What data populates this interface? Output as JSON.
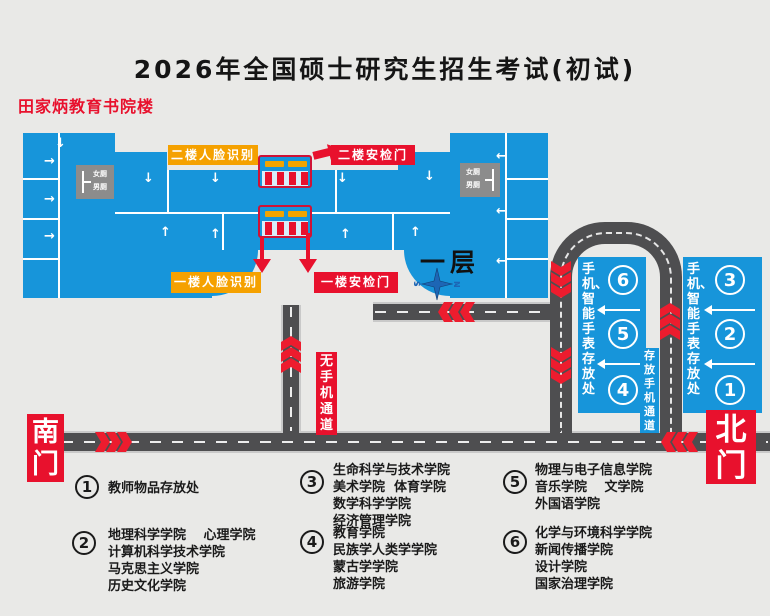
{
  "title": "2026年全国硕士研究生招生考试(初试)",
  "building": {
    "name": "田家炳教育书院楼",
    "floor_label": "一层",
    "restroom_female": "女厕",
    "restroom_male": "男厕",
    "labels": {
      "face_l2": "二楼人脸识别",
      "security_l2": "二楼安检门",
      "face_l1": "一楼人脸识别",
      "security_l1": "一楼安检门"
    }
  },
  "gates": {
    "south": "南门",
    "north": "北门"
  },
  "paths": {
    "no_phone": "无手机通道",
    "store_phone": "存放手机通道"
  },
  "storage_boxes": [
    {
      "label": "手机、智能手表存放处",
      "numbers": [
        "6",
        "5",
        "4"
      ]
    },
    {
      "label": "手机、智能手表存放处",
      "numbers": [
        "3",
        "2",
        "1"
      ]
    }
  ],
  "compass": {
    "left": "S",
    "right": "N"
  },
  "legend": [
    {
      "num": "1",
      "lines": [
        "教师物品存放处"
      ]
    },
    {
      "num": "2",
      "lines": [
        "地理科学学院　 心理学院",
        "计算机科学技术学院",
        "马克思主义学院",
        "历史文化学院"
      ]
    },
    {
      "num": "3",
      "lines": [
        "生命科学与技术学院",
        "美术学院  体育学院",
        "数学科学学院",
        "经济管理学院"
      ]
    },
    {
      "num": "4",
      "lines": [
        "教育学院",
        "民族学人类学学院",
        "蒙古学学院",
        "旅游学院"
      ]
    },
    {
      "num": "5",
      "lines": [
        "物理与电子信息学院",
        "音乐学院　 文学院",
        "外国语学院"
      ]
    },
    {
      "num": "6",
      "lines": [
        "化学与环境科学学院",
        "新闻传播学院",
        "设计学院",
        "国家治理学院"
      ]
    }
  ],
  "colors": {
    "building_blue": "#1795da",
    "road_gray": "#4e4e50",
    "accent_red": "#e8112d",
    "accent_orange": "#f5a100",
    "background": "#e9e9e7"
  }
}
